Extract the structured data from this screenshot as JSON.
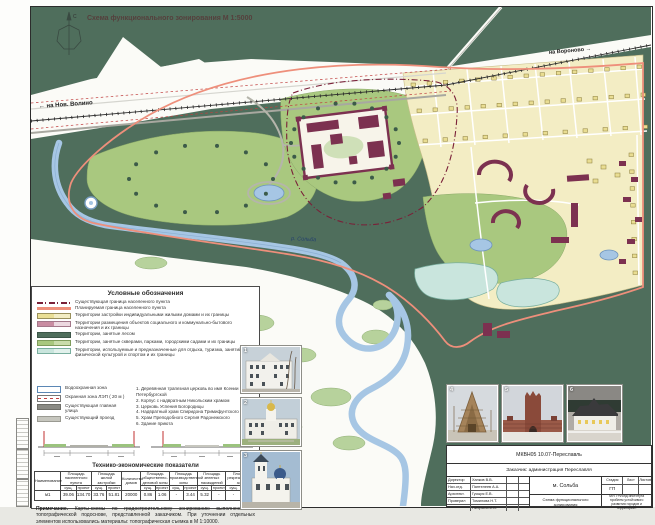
{
  "page": {
    "title": "Схема функционального зонирования М 1:5000",
    "compass": "С",
    "road_left": "← на Нов. Волино",
    "road_right": "на Вороново →",
    "river": "р. Сольба"
  },
  "colors": {
    "forest": "#4f6e5c",
    "park": "#a9c87f",
    "residential": "#f3edc4",
    "social": "#c98da2",
    "recreation": "#c9e5dd",
    "water": "#a6c6e4",
    "boundary_planned": "#ee8f7b",
    "boundary_existing": "#7a2038",
    "building": "#7c3150"
  },
  "legend": {
    "title": "Условные обозначения",
    "items": [
      {
        "type": "boundary-existing",
        "label": "Существующая граница населенного пункта"
      },
      {
        "type": "boundary-planned",
        "label": "Планируемая граница населенного пункта"
      },
      {
        "type": "residential",
        "label": "Территории застройки индивидуальными жилыми домами и их границы"
      },
      {
        "type": "social",
        "label": "Территории размещения объектов социального и коммунально-бытового назначения и их границы"
      },
      {
        "type": "forest",
        "label": "Территории, занятые лесом"
      },
      {
        "type": "parks",
        "label": "Территории, занятые скверами, парками, городскими садами и их границы"
      },
      {
        "type": "recreation",
        "label": "Территории, используемые и предназначенные для отдыха, туризма, занятий физической культурой и спортом и их границы"
      },
      {
        "type": "water-protect",
        "label": "Водоохранная зона"
      },
      {
        "type": "lep",
        "label": "Охранная зона ЛЭП ( 20 м )"
      },
      {
        "type": "main-street",
        "label": "Существующая главная улица"
      },
      {
        "type": "drive",
        "label": "Существующий проезд"
      }
    ],
    "landmarks": [
      "1. Деревянная трапезная церковь во имя Ксении Петербургской",
      "2. Корпус с надвратным Никольским храмом",
      "3. Церковь Успения Богородицы",
      "4. Надвратный храм Спиридона Тримифунтского",
      "5. Храм Преподобного Сергия Радонежского",
      "6. Здание приюта"
    ]
  },
  "table": {
    "title": "Технико-экономические показатели",
    "headers": [
      "Наименование",
      "Площадь населенного пункта",
      "Площадь жилой застройки",
      "Количество домов",
      "Площадь общественно-деловой зоны",
      "Площадь производственной зоны",
      "Площадь зеленых насаждений",
      "Площадь рекреационной зоны"
    ],
    "sub": {
      "exist": "сущ.",
      "plan": "проект"
    },
    "row": {
      "name": "м1",
      "np_e": "39.06",
      "np_p": "134.70",
      "rz_e": "33.76",
      "rz_p": "51.81",
      "houses": "20000",
      "od_e": "0.86",
      "od_p": "1.06",
      "pr_e": "-",
      "pr_p": "3.44",
      "zn_e": "5.32",
      "zn_p": "-",
      "rk_e": "-",
      "rk_p": "21.77"
    }
  },
  "note": {
    "label": "Примечание.",
    "text": "Карты-схемы по градостроительному зонированию выполнены по топографической подоснове, представленной заказчиком. При уточнении отдельных элементов использовались материалы: топографическая съемка в М 1:10000."
  },
  "photos": {
    "vertical": [
      {
        "num": "1"
      },
      {
        "num": "2"
      },
      {
        "num": "3"
      }
    ],
    "row": [
      {
        "num": "4"
      },
      {
        "num": "5"
      },
      {
        "num": "6"
      }
    ]
  },
  "title_block": {
    "code": "МКВН05 10.07-Переславль",
    "client": "Заказчик: администрация Переславля",
    "object": "м. Сольба",
    "drawing": "Схема функционального зонирования",
    "org": "МУП «Фонд института проблем устойчивого развития городов и территорий»",
    "stage_label": "Стадия",
    "list_label": "Лист",
    "lists_label": "Листов",
    "stage": "ГП",
    "signers": [
      [
        "Директор",
        "Хапков В.В."
      ],
      [
        "Нач.отд.",
        "Пантелеев А.А."
      ],
      [
        "Архитект.",
        "Гусыря Е.В."
      ],
      [
        "Проверил",
        "Томилова Н.Т."
      ],
      [
        "",
        "Пичугина И.В."
      ]
    ]
  }
}
